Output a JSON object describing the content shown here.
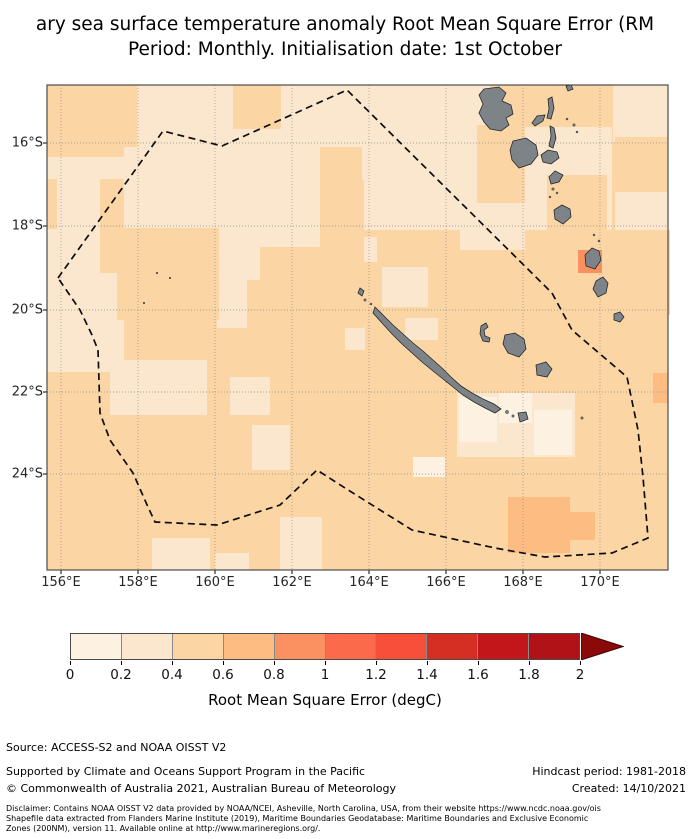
{
  "title": {
    "line1": "ary sea surface temperature anomaly Root Mean Square Error (RM",
    "line2": "Period: Monthly. Initialisation date: 1st October"
  },
  "map": {
    "frame": {
      "left": 47,
      "top": 85,
      "width": 621,
      "height": 485
    },
    "x_ticks": [
      {
        "label": "156°E",
        "x": 61
      },
      {
        "label": "158°E",
        "x": 138
      },
      {
        "label": "160°E",
        "x": 215
      },
      {
        "label": "162°E",
        "x": 292
      },
      {
        "label": "164°E",
        "x": 369
      },
      {
        "label": "166°E",
        "x": 446
      },
      {
        "label": "168°E",
        "x": 523
      },
      {
        "label": "170°E",
        "x": 600
      }
    ],
    "y_ticks": [
      {
        "label": "16°S",
        "y": 143
      },
      {
        "label": "18°S",
        "y": 226
      },
      {
        "label": "20°S",
        "y": 310
      },
      {
        "label": "22°S",
        "y": 392
      },
      {
        "label": "24°S",
        "y": 474
      }
    ],
    "grid_x": [
      14,
      91,
      168,
      245,
      322,
      399,
      476,
      553
    ],
    "grid_y": [
      58,
      141,
      225,
      307,
      389
    ],
    "colors": {
      "land": "#7d8387",
      "land_edge": "#26292c",
      "grid": "#8c8c8c",
      "eez_line": "#0d0d0d",
      "frame": "#4d4d4d",
      "base_bin": 2
    },
    "patches": [
      {
        "x": 90,
        "y": 0,
        "w": 353,
        "h": 62,
        "bin": 1
      },
      {
        "x": 566,
        "y": 0,
        "w": 55,
        "h": 57,
        "bin": 1
      },
      {
        "x": 0,
        "y": 72,
        "w": 77,
        "h": 215,
        "bin": 1
      },
      {
        "x": 77,
        "y": 62,
        "w": 196,
        "h": 100,
        "bin": 1
      },
      {
        "x": 315,
        "y": 42,
        "w": 250,
        "h": 103,
        "bin": 1
      },
      {
        "x": 170,
        "y": 143,
        "w": 43,
        "h": 100,
        "bin": 1
      },
      {
        "x": 2,
        "y": 182,
        "w": 66,
        "h": 73,
        "bin": 1
      },
      {
        "x": 63,
        "y": 275,
        "w": 97,
        "h": 55,
        "bin": 1
      },
      {
        "x": 105,
        "y": 453,
        "w": 58,
        "h": 32,
        "bin": 1
      },
      {
        "x": 168,
        "y": 468,
        "w": 34,
        "h": 17,
        "bin": 1
      },
      {
        "x": 183,
        "y": 292,
        "w": 40,
        "h": 38,
        "bin": 1
      },
      {
        "x": 205,
        "y": 340,
        "w": 38,
        "h": 45,
        "bin": 1
      },
      {
        "x": 233,
        "y": 432,
        "w": 42,
        "h": 53,
        "bin": 1
      },
      {
        "x": 410,
        "y": 308,
        "w": 118,
        "h": 64,
        "bin": 1
      },
      {
        "x": 298,
        "y": 152,
        "w": 32,
        "h": 25,
        "bin": 1
      },
      {
        "x": 335,
        "y": 182,
        "w": 46,
        "h": 40,
        "bin": 1
      },
      {
        "x": 413,
        "y": 145,
        "w": 65,
        "h": 20,
        "bin": 1
      },
      {
        "x": 298,
        "y": 240,
        "w": 20,
        "h": 25,
        "bin": 1
      },
      {
        "x": 358,
        "y": 233,
        "w": 33,
        "h": 22,
        "bin": 1
      },
      {
        "x": 568,
        "y": 107,
        "w": 53,
        "h": 60,
        "bin": 1
      },
      {
        "x": 186,
        "y": 0,
        "w": 48,
        "h": 44,
        "bin": 2
      },
      {
        "x": 53,
        "y": 94,
        "w": 24,
        "h": 94,
        "bin": 2
      },
      {
        "x": 0,
        "y": 94,
        "w": 10,
        "h": 50,
        "bin": 2
      },
      {
        "x": 273,
        "y": 95,
        "w": 44,
        "h": 148,
        "bin": 2
      },
      {
        "x": 70,
        "y": 143,
        "w": 102,
        "h": 92,
        "bin": 2
      },
      {
        "x": 430,
        "y": 40,
        "w": 48,
        "h": 78,
        "bin": 2
      },
      {
        "x": 500,
        "y": 90,
        "w": 60,
        "h": 70,
        "bin": 2
      },
      {
        "x": 531,
        "y": 145,
        "w": 92,
        "h": 85,
        "bin": 2
      },
      {
        "x": 200,
        "y": 195,
        "w": 62,
        "h": 50,
        "bin": 2
      },
      {
        "x": 568,
        "y": 52,
        "w": 53,
        "h": 55,
        "bin": 2
      },
      {
        "x": 412,
        "y": 312,
        "w": 38,
        "h": 45,
        "bin": 0
      },
      {
        "x": 452,
        "y": 308,
        "w": 33,
        "h": 30,
        "bin": 0
      },
      {
        "x": 487,
        "y": 325,
        "w": 38,
        "h": 45,
        "bin": 0
      },
      {
        "x": 366,
        "y": 372,
        "w": 32,
        "h": 20,
        "bin": 0
      },
      {
        "x": 461,
        "y": 412,
        "w": 62,
        "h": 56,
        "bin": 3
      },
      {
        "x": 523,
        "y": 427,
        "w": 25,
        "h": 28,
        "bin": 3
      },
      {
        "x": 606,
        "y": 288,
        "w": 15,
        "h": 30,
        "bin": 3
      },
      {
        "x": 531,
        "y": 165,
        "w": 24,
        "h": 23,
        "bin": 4
      }
    ],
    "eez_points": [
      [
        11,
        193
      ],
      [
        116,
        46
      ],
      [
        175,
        61
      ],
      [
        300,
        5
      ],
      [
        505,
        208
      ],
      [
        525,
        245
      ],
      [
        580,
        292
      ],
      [
        591,
        345
      ],
      [
        596,
        392
      ],
      [
        601,
        453
      ],
      [
        565,
        468
      ],
      [
        498,
        472
      ],
      [
        448,
        463
      ],
      [
        365,
        445
      ],
      [
        298,
        403
      ],
      [
        270,
        385
      ],
      [
        233,
        420
      ],
      [
        170,
        440
      ],
      [
        108,
        437
      ],
      [
        101,
        422
      ],
      [
        86,
        388
      ],
      [
        63,
        355
      ],
      [
        53,
        328
      ],
      [
        51,
        265
      ],
      [
        45,
        250
      ],
      [
        33,
        225
      ]
    ],
    "islands": [
      {
        "name": "espiritu-santo",
        "d": "M437,4 L452,2 L459,8 L455,16 L464,20 L466,29 L459,33 L462,40 L454,46 L443,44 L437,37 L432,28 L436,19 L432,10 Z"
      },
      {
        "name": "malakula",
        "d": "M466,56 L479,53 L489,60 L491,70 L484,79 L472,83 L465,75 L463,65 Z"
      },
      {
        "name": "ambae",
        "d": "M485,38 L490,31 L498,30 L496,36 L488,41 Z"
      },
      {
        "name": "maewo",
        "d": "M501,14 L505,12 L507,23 L504,34 L500,33 L502,24 Z"
      },
      {
        "name": "pentecost",
        "d": "M503,41 L507,43 L509,53 L506,63 L502,61 L504,51 Z"
      },
      {
        "name": "ambrym",
        "d": "M494,70 L501,65 L510,67 L512,73 L504,79 L496,77 Z"
      },
      {
        "name": "epi",
        "d": "M502,92 L508,86 L516,90 L512,97 L504,99 Z"
      },
      {
        "name": "efate",
        "d": "M507,125 L515,120 L523,124 L524,132 L516,139 L508,134 Z"
      },
      {
        "name": "erromango",
        "d": "M538,170 L545,163 L552,166 L554,175 L548,184 L539,181 Z"
      },
      {
        "name": "tanna",
        "d": "M549,196 L556,192 L561,198 L559,208 L551,212 L546,204 Z"
      },
      {
        "name": "aneityum",
        "d": "M567,229 L573,227 L577,232 L573,237 L567,235 Z"
      },
      {
        "name": "banks-islet",
        "d": "M519,1 L524,0 L526,4 L521,6 Z"
      },
      {
        "name": "new-caledonia",
        "d": "M328,222 L336,230 L346,240 L356,249 L366,258 L376,266 L386,275 L395,283 L404,292 L414,301 L425,308 L436,314 L447,319 L454,324 L448,328 L438,323 L427,317 L416,310 L406,302 L396,294 L386,286 L375,277 L365,268 L355,259 L345,249 L335,238 L326,228 Z"
      },
      {
        "name": "belep",
        "d": "M313,203 L317,206 L315,211 L311,208 Z"
      },
      {
        "name": "ouvea",
        "d": "M434,241 L439,238 L441,242 L437,245 L438,251 L443,253 L442,257 L436,256 L433,249 Z"
      },
      {
        "name": "lifou",
        "d": "M458,250 L468,248 L477,254 L479,264 L472,272 L461,268 L456,259 Z"
      },
      {
        "name": "mare",
        "d": "M489,280 L499,277 L505,284 L500,292 L490,290 Z"
      },
      {
        "name": "ile-des-pins",
        "d": "M471,328 L479,327 L481,334 L473,337 Z"
      }
    ],
    "island_dots": [
      [
        506,
        104,
        1.2
      ],
      [
        510,
        108,
        1
      ],
      [
        503,
        112,
        1
      ],
      [
        520,
        34,
        1
      ],
      [
        527,
        40,
        1.2
      ],
      [
        530,
        47,
        1
      ],
      [
        318,
        215,
        1.2
      ],
      [
        324,
        219,
        1
      ],
      [
        460,
        327,
        1.6
      ],
      [
        466,
        331,
        1.2
      ],
      [
        535,
        333,
        1.2
      ],
      [
        547,
        150,
        1
      ],
      [
        552,
        156,
        1
      ]
    ],
    "reef_dots": [
      [
        110,
        188
      ],
      [
        123,
        193
      ],
      [
        97,
        218
      ]
    ]
  },
  "colorbar": {
    "segment_colors": [
      "#fdf2e1",
      "#fbe7cd",
      "#fbd5a4",
      "#fcbc82",
      "#fb9160",
      "#fb6b4b",
      "#f6503a",
      "#d52f23",
      "#c2161b",
      "#b11217"
    ],
    "over_color": "#8b0a09",
    "tick_labels": [
      "0",
      "0.2",
      "0.4",
      "0.6",
      "0.8",
      "1",
      "1.2",
      "1.4",
      "1.6",
      "1.8",
      "2"
    ],
    "geometry": {
      "left": 70,
      "top": 633,
      "width": 510,
      "height": 27,
      "arrow_width": 42
    },
    "axis_label": "Root Mean Square Error (degC)"
  },
  "footer": {
    "source": "Source: ACCESS-S2 and NOAA OISST V2",
    "supported": "Supported by Climate and Oceans Support Program in the Pacific",
    "hindcast": "Hindcast period: 1981-2018",
    "copyright": "© Commonwealth of Australia 2021, Australian Bureau of Meteorology",
    "created": "Created: 14/10/2021",
    "disclaimer_lines": [
      "Disclaimer: Contains NOAA OISST V2 data provided by NOAA/NCEI, Asheville, North Carolina, USA, from their website https://www.ncdc.noaa.gov/ois",
      "Shapefile data extracted from Flanders Marine Institute (2019), Maritime Boundaries Geodatabase: Maritime Boundaries and Exclusive Economic",
      "Zones (200NM), version 11. Available online at http://www.marineregions.org/."
    ]
  }
}
